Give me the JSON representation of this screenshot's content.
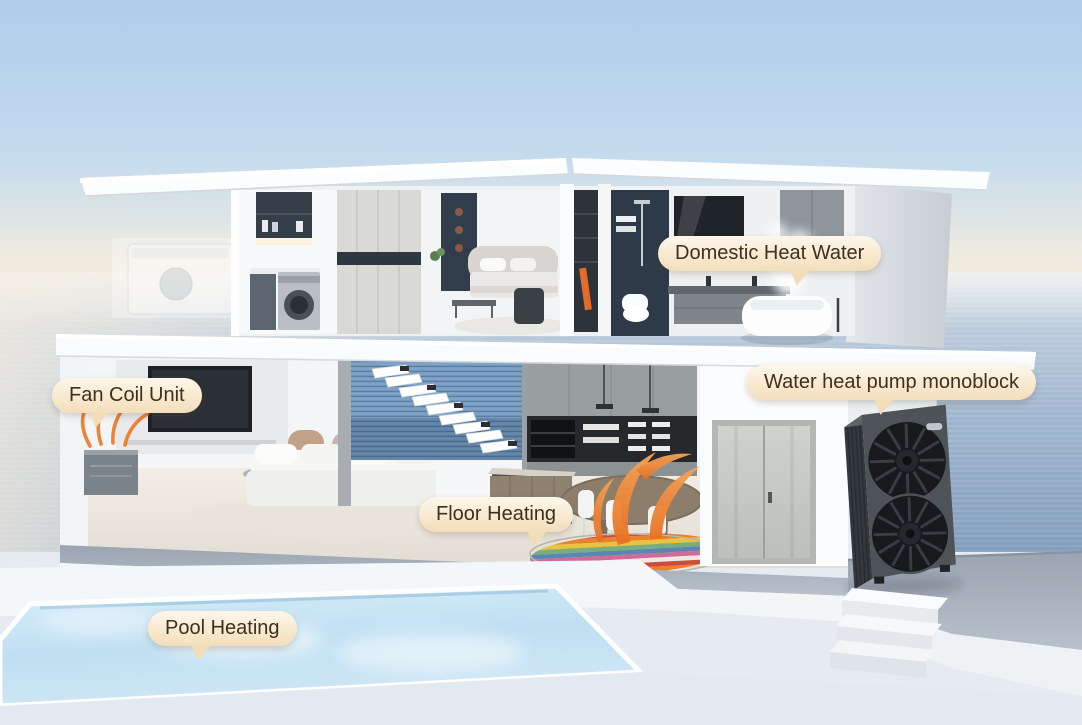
{
  "callouts": [
    {
      "id": "domestic-heat-water",
      "label": "Domestic Heat Water"
    },
    {
      "id": "water-heat-pump-monoblock",
      "label": "Water heat pump monoblock"
    },
    {
      "id": "fan-coil-unit",
      "label": "Fan Coil Unit"
    },
    {
      "id": "floor-heating",
      "label": "Floor Heating"
    },
    {
      "id": "pool-heating",
      "label": "Pool Heating"
    }
  ],
  "colors": {
    "callout_background": "#f8e9cf",
    "callout_text": "#3e2f1e",
    "airflow_accent_orange": "#ee7d2b",
    "sky_blue": "#b2cfe9",
    "horizon_warm": "#f6ecd9",
    "sea_blue": "#86a3c2",
    "pool_water": "#c8e4f4",
    "heat_pump_body": "#4c5257",
    "house_white": "#f5f7f8"
  },
  "illustration": {
    "elements": [
      "two-storey-villa-cutaway",
      "laundry-room-washing-machine",
      "bedroom",
      "bathroom-bathtub-steam",
      "living-room-tv-sofa",
      "floating-staircase",
      "kitchen-dining",
      "entry-double-door",
      "outdoor-monoblock-heat-pump",
      "wall-fan-coil-unit",
      "floor-heating-rug",
      "swimming-pool",
      "outdoor-steps",
      "sea-horizon-background"
    ]
  }
}
